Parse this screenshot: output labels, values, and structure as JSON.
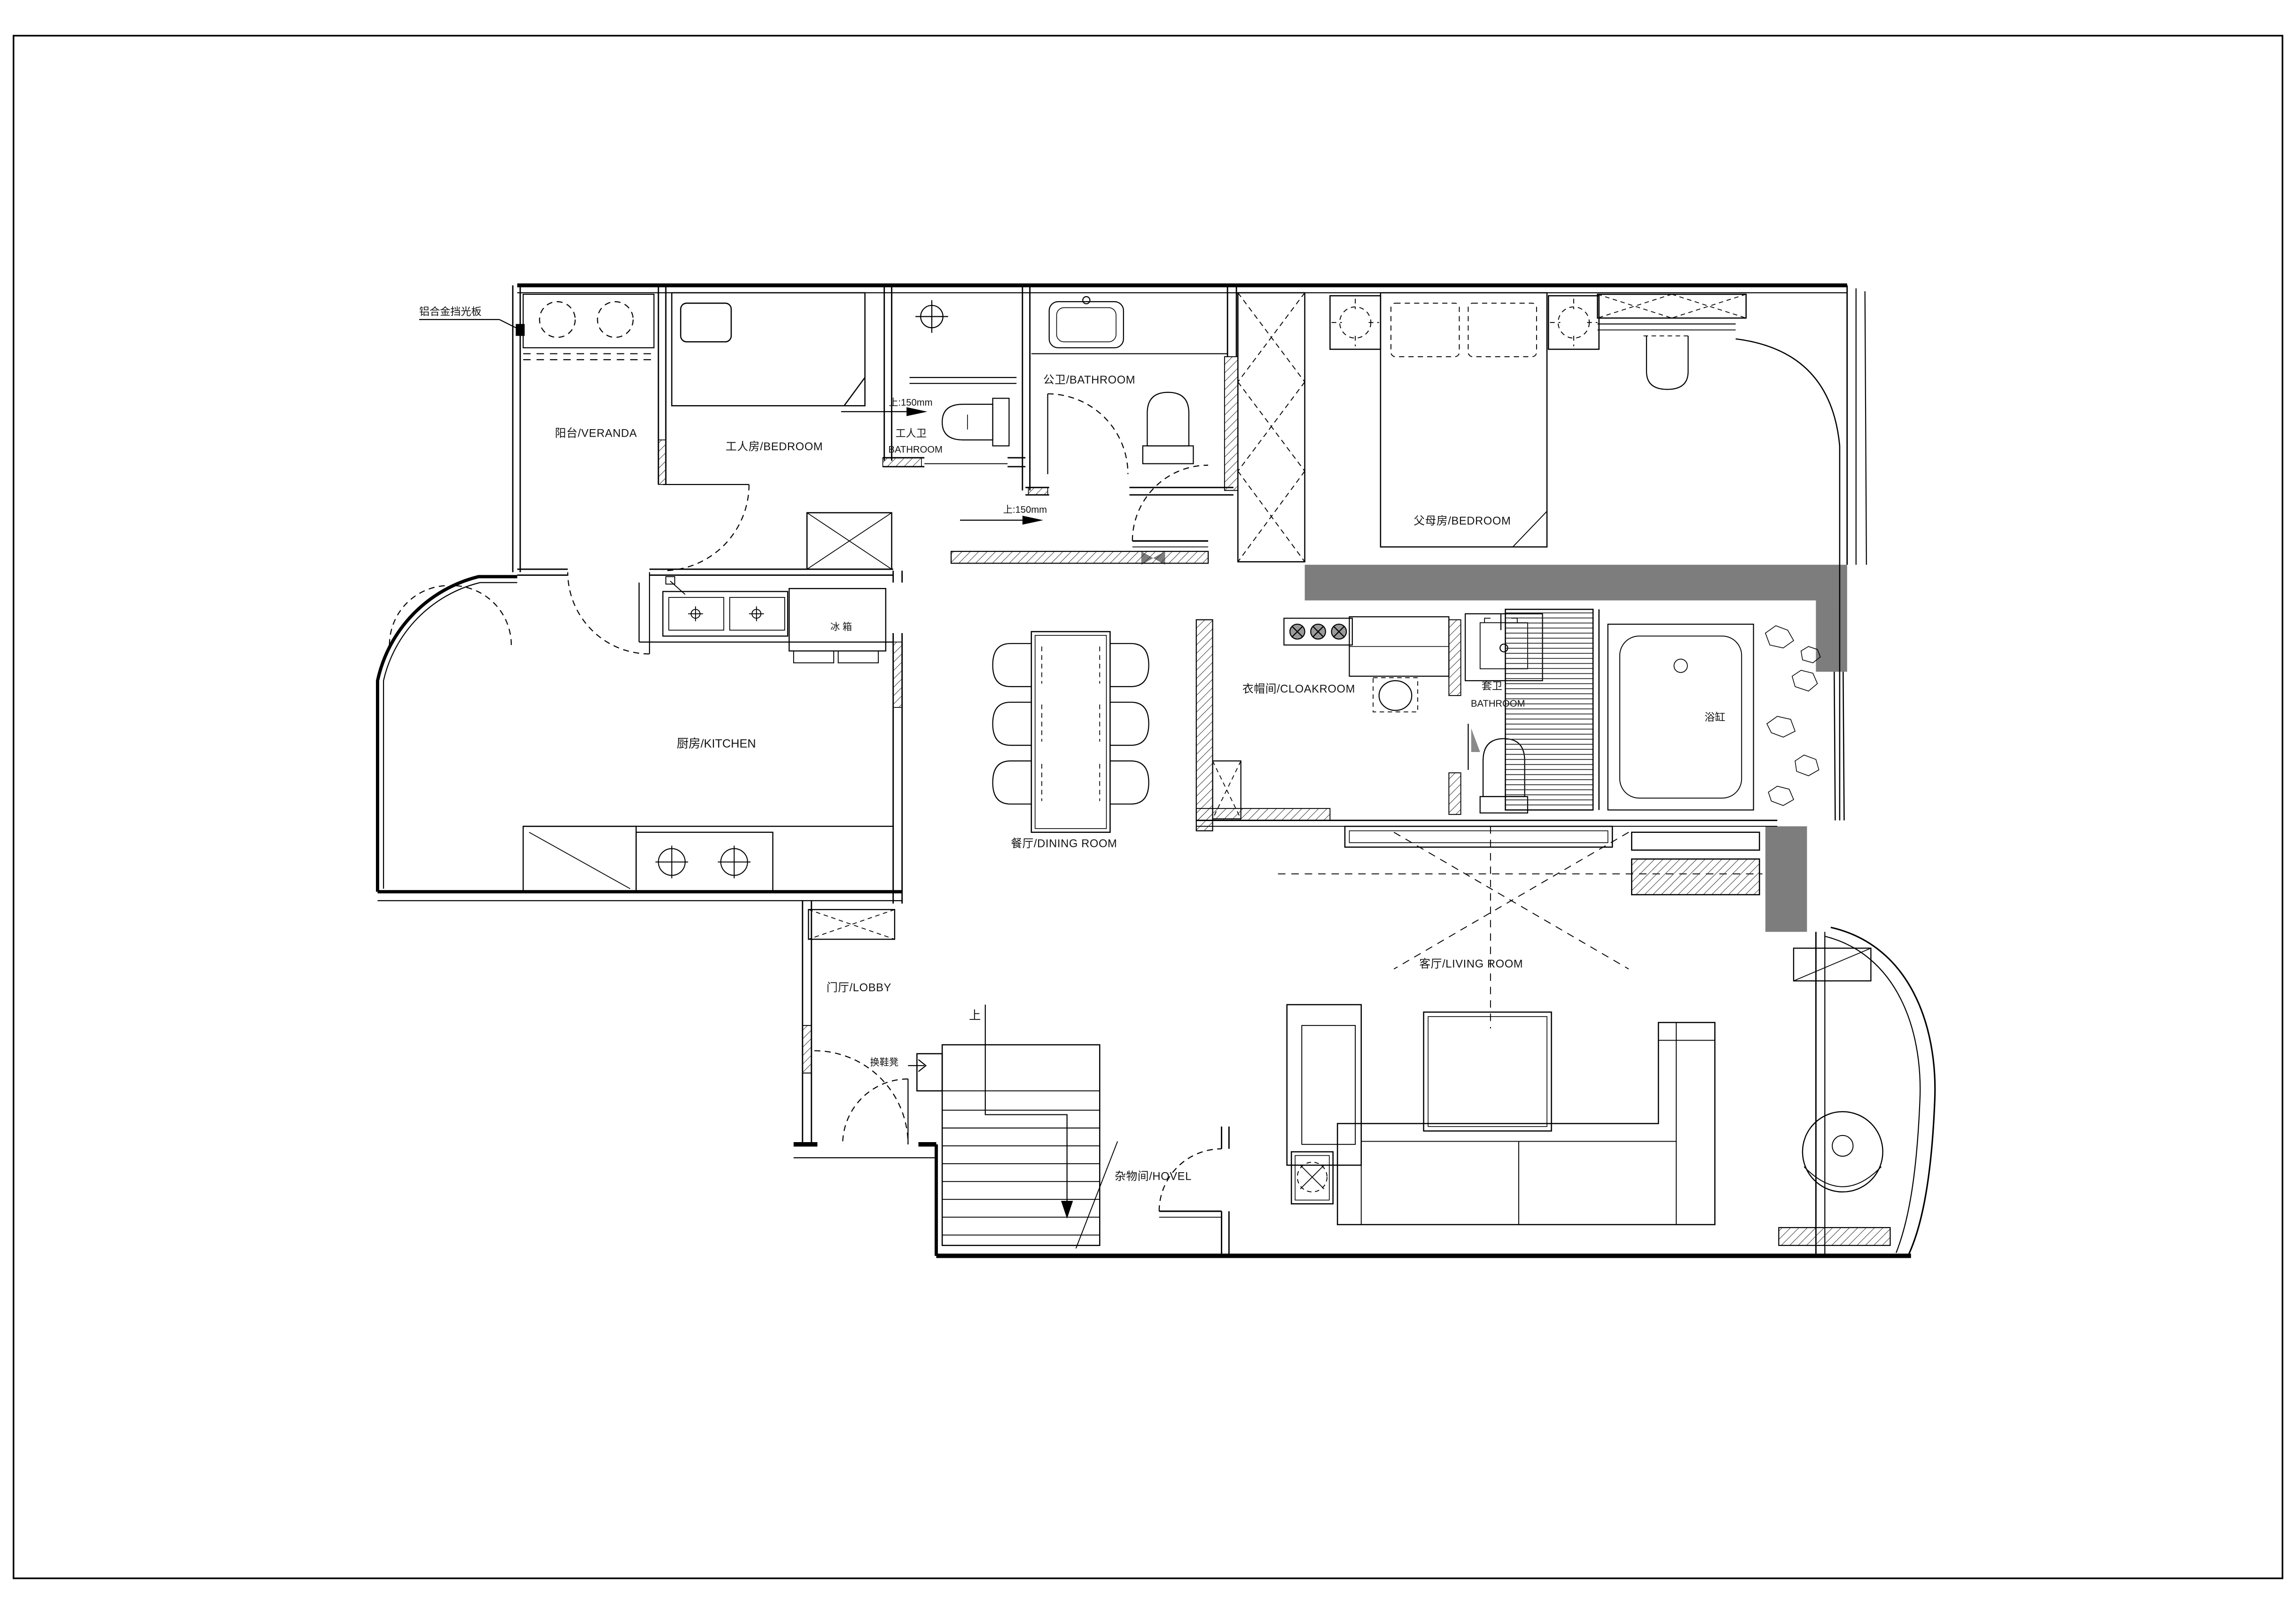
{
  "drawing": {
    "type": "residential-floor-plan",
    "background": "#ffffff",
    "line_color": "#000000",
    "wall_fill_color": "#7d7d7d"
  },
  "labels": {
    "aluminum_panel": "铝合金挡光板",
    "veranda": "阳台/VERANDA",
    "maid_room": "工人房/BEDROOM",
    "maid_bath_line1": "工人卫",
    "maid_bath_line2": "BATHROOM",
    "step_up_1": "上:150mm",
    "public_bath": "公卫/BATHROOM",
    "parents_room": "父母房/BEDROOM",
    "step_up_2": "上:150mm",
    "cloakroom": "衣帽间/CLOAKROOM",
    "suite_bath_line1": "套卫",
    "suite_bath_line2": "BATHROOM",
    "bathtub": "浴缸",
    "fridge": "冰 箱",
    "kitchen": "厨房/KITCHEN",
    "dining": "餐厅/DINING ROOM",
    "living": "客厅/LIVING ROOM",
    "lobby": "门厅/LOBBY",
    "shoe_bench": "换鞋凳",
    "stairs_up": "上",
    "storage": "杂物间/HOVEL"
  }
}
